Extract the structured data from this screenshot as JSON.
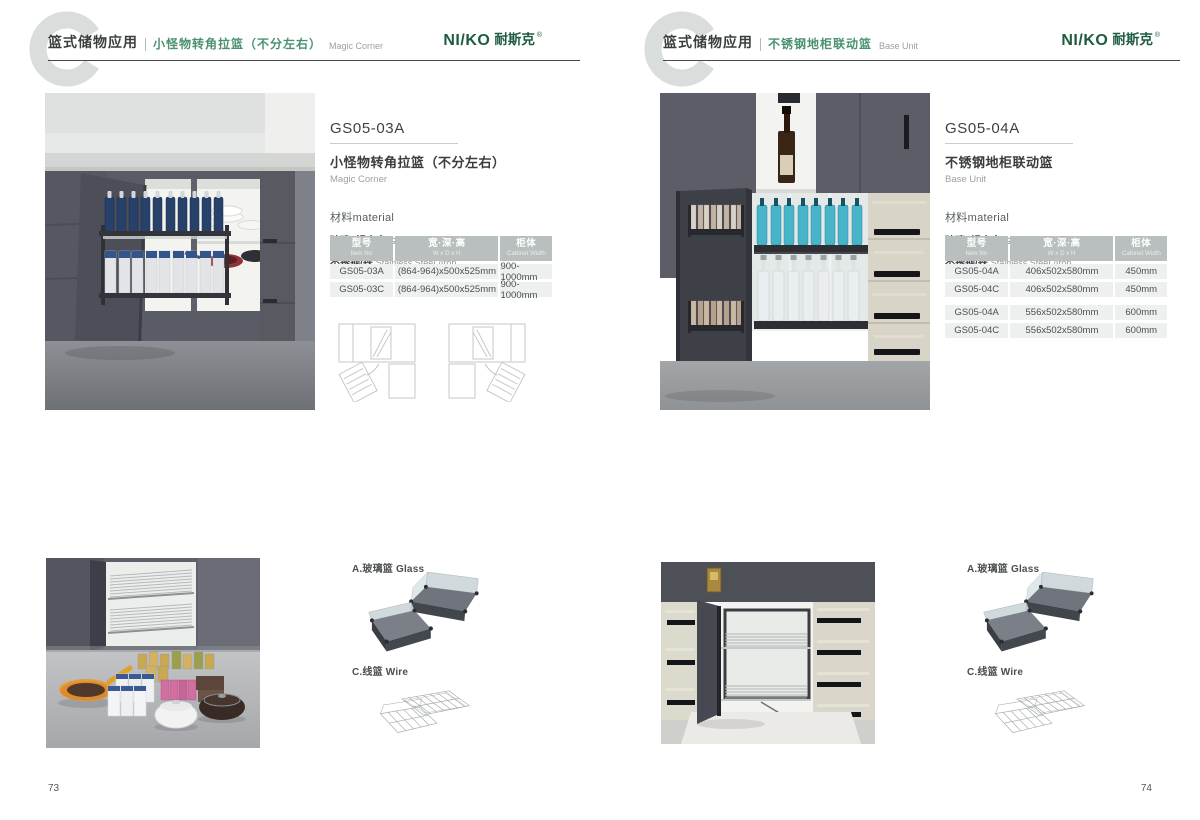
{
  "brand": {
    "logo_latin": "NI/KO",
    "logo_cn": "耐斯克",
    "registered": "®"
  },
  "colors": {
    "accent_green": "#4a9170",
    "logo_green": "#1d5c3e",
    "table_header_bg": "#b9bfbe",
    "table_row_bg": "#eef0f0",
    "dark_text": "#3a3f3d",
    "gray_text": "#9aa29e",
    "watermark_gray": "#d9dddc"
  },
  "pages": [
    {
      "page_number": "73",
      "header": {
        "category_cn": "篮式储物应用",
        "product_cn": "小怪物转角拉篮（不分左右）",
        "product_en": "Magic Corner"
      },
      "info": {
        "model": "GS05-03A",
        "name_cn": "小怪物转角拉篮（不分左右）",
        "name_en": "Magic Corner",
        "material_title": "材料material",
        "material_1_cn": "玻璃+铝合金",
        "material_1_en": "Glass+Aluminum",
        "material_2_cn": "不锈钢/铁",
        "material_2_en": "Stainless SteeL/Iron"
      },
      "table": {
        "col1_cn": "型号",
        "col1_en": "Item No",
        "col2_cn": "宽·深·高",
        "col2_en": "W x D x H",
        "col3_cn": "柜体",
        "col3_en": "Cabinet Width",
        "rows": [
          {
            "model": "GS05-03A",
            "size": "(864-964)x500x525mm",
            "cabinet": "900-1000mm"
          },
          {
            "model": "GS05-03C",
            "size": "(864-964)x500x525mm",
            "cabinet": "900-1000mm"
          }
        ]
      },
      "components": {
        "glass": "A.玻璃篮 Glass",
        "wire": "C.线篮 Wire"
      }
    },
    {
      "page_number": "74",
      "header": {
        "category_cn": "篮式储物应用",
        "product_cn": "不锈钢地柜联动篮",
        "product_en": "Base Unit"
      },
      "info": {
        "model": "GS05-04A",
        "name_cn": "不锈钢地柜联动篮",
        "name_en": "Base Unit",
        "material_title": "材料material",
        "material_1_cn": "玻璃+铝合金",
        "material_1_en": "Glass+Aluminum",
        "material_2_cn": "不锈钢/铁",
        "material_2_en": "Stainless SteeL/Iron"
      },
      "table": {
        "col1_cn": "型号",
        "col1_en": "Item No",
        "col2_cn": "宽·深·高",
        "col2_en": "W x D x H",
        "col3_cn": "柜体",
        "col3_en": "Cabinet Width",
        "rows": [
          {
            "model": "GS05-04A",
            "size": "406x502x580mm",
            "cabinet": "450mm"
          },
          {
            "model": "GS05-04C",
            "size": "406x502x580mm",
            "cabinet": "450mm"
          },
          {
            "model": "GS05-04A",
            "size": "556x502x580mm",
            "cabinet": "600mm"
          },
          {
            "model": "GS05-04C",
            "size": "556x502x580mm",
            "cabinet": "600mm"
          }
        ]
      },
      "components": {
        "glass": "A.玻璃篮 Glass",
        "wire": "C.线篮 Wire"
      }
    }
  ]
}
